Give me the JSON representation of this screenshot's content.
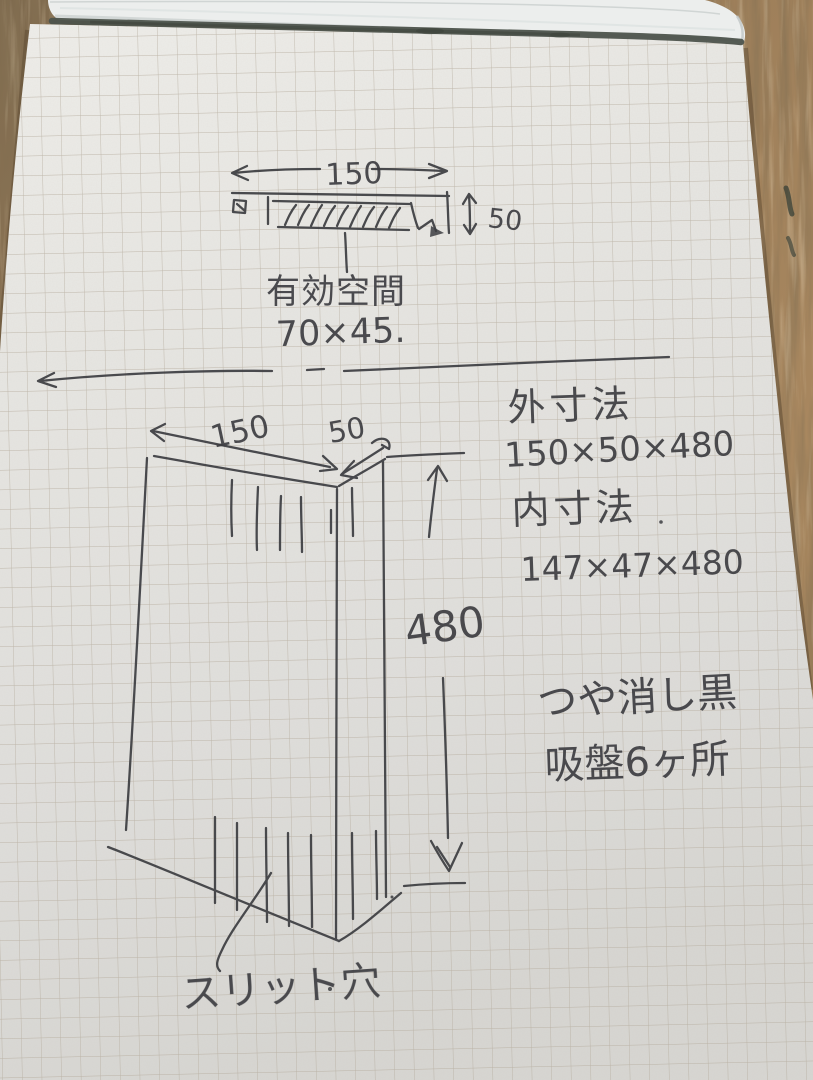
{
  "top_sketch": {
    "width_label": "150",
    "height_label": "50",
    "caption_line1": "有効空間",
    "caption_line2": "70×45."
  },
  "main_sketch": {
    "width_label": "150",
    "depth_label": "50",
    "length_label": "480",
    "slit_label": "スリット穴"
  },
  "notes": {
    "outer_title": "外寸法",
    "outer_value": "150×50×480",
    "inner_title": "内寸法",
    "inner_value": "147×47×480",
    "finish_note": "つや消し黒",
    "suction_note": "吸盤6ヶ所"
  },
  "colors": {
    "ink": "#3c3d41",
    "paper": "#e4e3df",
    "grid_line": "#b4aa9b",
    "wood": "#9a7c58",
    "binding": "#4d534c"
  }
}
